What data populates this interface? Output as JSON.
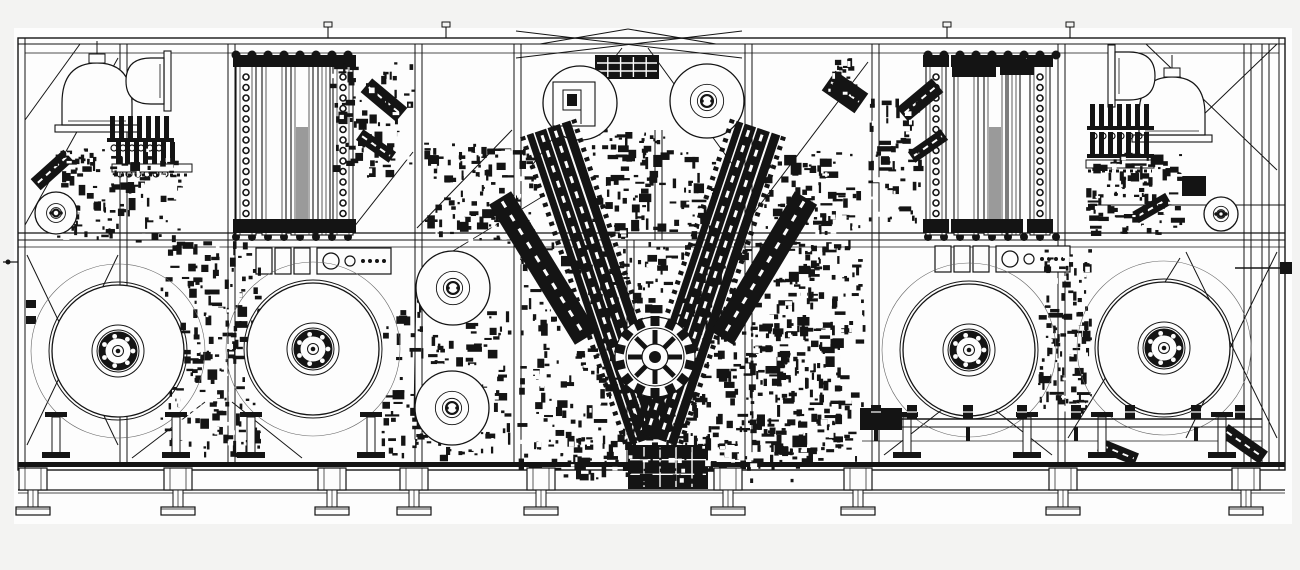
{
  "meta": {
    "canvas": {
      "w": 1300,
      "h": 570
    },
    "colors": {
      "ink": "#141414",
      "paper": "#fdfdfd",
      "page": "#f3f3f2",
      "faint": "#666666",
      "gray": "#9a9a9a"
    }
  },
  "frame": {
    "paper": [
      14,
      28,
      1278,
      496
    ],
    "outer": [
      18,
      38,
      1267,
      432
    ],
    "hlines": [
      [
        18,
        44,
        1285,
        1
      ],
      [
        25,
        53,
        1279,
        0.8
      ],
      [
        18,
        233,
        1285,
        1.2
      ],
      [
        18,
        240,
        1285,
        1
      ],
      [
        18,
        247,
        1285,
        0.7
      ],
      [
        1090,
        205,
        1285,
        1
      ],
      [
        862,
        441,
        1262,
        0.8
      ]
    ],
    "vlines": [
      [
        25,
        38,
        470,
        1
      ],
      [
        1279,
        38,
        470,
        1
      ]
    ],
    "columns": {
      "xs": [
        120,
        228,
        415,
        514,
        745,
        872,
        1058,
        1244,
        1262
      ],
      "y0": 44,
      "y1": 462,
      "w": 7
    },
    "partial_columns": [
      [
        627,
        240,
        462
      ],
      [
        655,
        130,
        240
      ]
    ],
    "base": {
      "x": 18,
      "w": 1267,
      "band_y": 462,
      "band_h": 5,
      "rail_y": 490,
      "rail2_y": 493
    },
    "stubs": [
      328,
      446,
      947,
      1070
    ],
    "left_marks": {
      "line": [
        3,
        262,
        18,
        262
      ],
      "dot": [
        8,
        262,
        2.5
      ],
      "tabs": [
        [
          26,
          300,
          10,
          8
        ],
        [
          26,
          316,
          10,
          8
        ]
      ]
    },
    "probe": {
      "line": [
        1235,
        268,
        1286,
        268
      ],
      "tip": [
        1280,
        262,
        12,
        12
      ]
    }
  },
  "braces": [
    [
      25,
      225,
      118,
      58
    ],
    [
      25,
      120,
      80,
      44
    ],
    [
      27,
      445,
      118,
      255
    ],
    [
      27,
      255,
      118,
      445
    ],
    [
      350,
      232,
      413,
      152
    ],
    [
      417,
      228,
      512,
      130
    ],
    [
      540,
      44,
      628,
      29
    ],
    [
      628,
      29,
      716,
      44
    ],
    [
      516,
      58,
      742,
      31
    ],
    [
      516,
      31,
      742,
      58
    ],
    [
      530,
      168,
      622,
      48
    ],
    [
      735,
      168,
      648,
      48
    ],
    [
      747,
      222,
      868,
      62
    ],
    [
      1146,
      44,
      1277,
      170
    ],
    [
      1277,
      44,
      1200,
      118
    ],
    [
      1186,
      252,
      1277,
      438
    ],
    [
      1277,
      252,
      1186,
      438
    ],
    [
      1068,
      438,
      1180,
      258
    ],
    [
      132,
      458,
      205,
      402
    ],
    [
      232,
      402,
      302,
      458
    ],
    [
      884,
      455,
      952,
      402
    ],
    [
      985,
      402,
      1052,
      455
    ],
    [
      416,
      290,
      414,
      410,
      0.8
    ],
    [
      453,
      251,
      545,
      195,
      0.8
    ]
  ],
  "towers": {
    "bays": [
      {
        "x0": 228,
        "x1": 360,
        "y0": 57,
        "y1": 235,
        "tracks": [
          {
            "x": 236,
            "w": 20,
            "chain": true
          },
          {
            "x": 262,
            "w": 24
          },
          {
            "x": 291,
            "w": 22,
            "gray": true
          },
          {
            "x": 318,
            "w": 12
          },
          {
            "x": 333,
            "w": 20,
            "chain": true
          }
        ]
      },
      {
        "x0": 920,
        "x1": 1074,
        "y0": 57,
        "y1": 235,
        "tracks": [
          {
            "x": 926,
            "w": 20,
            "chain": true
          },
          {
            "x": 954,
            "w": 24
          },
          {
            "x": 984,
            "w": 22,
            "gray": true
          },
          {
            "x": 1008,
            "w": 12
          },
          {
            "x": 1030,
            "w": 20,
            "chain": true
          }
        ]
      }
    ]
  },
  "domes": [
    {
      "cx": 97,
      "baseY": 132,
      "w": 70,
      "h": 62,
      "rot": 0,
      "neck": true
    },
    {
      "cx": 152,
      "baseY": 100,
      "w": 46,
      "h": 38,
      "rot": -90,
      "neck": false
    },
    {
      "cx": 1172,
      "baseY": 142,
      "w": 66,
      "h": 58,
      "rot": 0,
      "neck": true
    },
    {
      "cx": 1128,
      "baseY": 96,
      "w": 48,
      "h": 40,
      "rot": 90,
      "neck": false
    }
  ],
  "combs": [
    {
      "x": 110,
      "y": 116,
      "n": 7
    },
    {
      "x": 116,
      "y": 142,
      "n": 7
    },
    {
      "x": 1090,
      "y": 104,
      "n": 7
    },
    {
      "x": 1090,
      "y": 132,
      "n": 7
    }
  ],
  "toothed_rails": [
    [
      112,
      164,
      80
    ],
    [
      1086,
      160,
      68
    ]
  ],
  "modrows": [
    {
      "x": 256,
      "y": 248,
      "boxes": 3,
      "panel": true
    },
    {
      "x": 935,
      "y": 246,
      "boxes": 3,
      "panel": true
    }
  ],
  "reels": [
    {
      "cx": 118,
      "cy": 351
    },
    {
      "cx": 313,
      "cy": 349
    },
    {
      "cx": 969,
      "cy": 350
    },
    {
      "cx": 1164,
      "cy": 348
    }
  ],
  "reel_style": {
    "r_faint": 87,
    "r_ring": 69,
    "r_disc": 66,
    "hub_rings": [
      26,
      21
    ],
    "dark_r": 16,
    "bolt_radius": 15,
    "bolt_n": 7
  },
  "stand_offsets": [
    -62,
    58
  ],
  "rolls": [
    {
      "cx": 580,
      "cy": 103,
      "r": 37,
      "style": "boxed"
    },
    {
      "cx": 707,
      "cy": 101,
      "r": 37,
      "style": "hub"
    },
    {
      "cx": 453,
      "cy": 288,
      "r": 37,
      "style": "hub"
    },
    {
      "cx": 452,
      "cy": 408,
      "r": 37,
      "style": "hub"
    },
    {
      "cx": 56,
      "cy": 213,
      "r": 21,
      "style": "hub"
    },
    {
      "cx": 1221,
      "cy": 214,
      "r": 17,
      "style": "hub"
    }
  ],
  "arms": [
    {
      "p1": [
        548,
        128
      ],
      "p2": [
        652,
        438
      ],
      "outer": false
    },
    {
      "p1": [
        758,
        128
      ],
      "p2": [
        654,
        438
      ],
      "outer": false
    },
    {
      "p1": [
        500,
        198
      ],
      "p2": [
        586,
        338
      ],
      "outer": true
    },
    {
      "p1": [
        806,
        198
      ],
      "p2": [
        722,
        338
      ],
      "outer": true
    }
  ],
  "gear": {
    "cx": 655,
    "cy": 357,
    "r": 40,
    "teeth": 14,
    "spokes": 8
  },
  "conveyor": {
    "y": 419,
    "y2": 427,
    "x0": 862,
    "x1": 1262,
    "posts": [
      876,
      912,
      968,
      1022,
      1076,
      1130,
      1196,
      1240
    ],
    "end_block": [
      860,
      408,
      42,
      22
    ]
  },
  "chutes": [
    {
      "cx": 1244,
      "cy": 444,
      "w": 48,
      "h": 15,
      "rot": 35
    },
    {
      "cx": 1118,
      "cy": 452,
      "w": 40,
      "h": 13,
      "rot": 22
    },
    {
      "cx": 384,
      "cy": 100,
      "w": 46,
      "h": 18,
      "rot": 40
    },
    {
      "cx": 376,
      "cy": 146,
      "w": 40,
      "h": 13,
      "rot": 35
    },
    {
      "cx": 920,
      "cy": 100,
      "w": 46,
      "h": 18,
      "rot": -40
    },
    {
      "cx": 928,
      "cy": 146,
      "w": 40,
      "h": 13,
      "rot": -35
    },
    {
      "cx": 52,
      "cy": 170,
      "w": 44,
      "h": 15,
      "rot": -42
    },
    {
      "cx": 1152,
      "cy": 208,
      "w": 38,
      "h": 13,
      "rot": -30
    },
    {
      "cx": 845,
      "cy": 92,
      "w": 40,
      "h": 24,
      "rot": 35
    }
  ],
  "blocks": [
    {
      "x": 595,
      "y": 55,
      "w": 64,
      "h": 24,
      "grid": true
    },
    {
      "x": 952,
      "y": 57,
      "w": 44,
      "h": 20,
      "grid": false
    },
    {
      "x": 1000,
      "y": 59,
      "w": 34,
      "h": 16,
      "grid": false
    },
    {
      "x": 628,
      "y": 445,
      "w": 80,
      "h": 44,
      "grid": true
    },
    {
      "x": 1182,
      "y": 176,
      "w": 24,
      "h": 20,
      "grid": false
    }
  ],
  "clusters": [
    {
      "x": 55,
      "y": 148,
      "w": 130,
      "h": 95,
      "n": 110,
      "seed": 11
    },
    {
      "x": 330,
      "y": 62,
      "w": 88,
      "h": 118,
      "n": 70,
      "seed": 12
    },
    {
      "x": 420,
      "y": 142,
      "w": 118,
      "h": 102,
      "n": 110,
      "seed": 13
    },
    {
      "x": 866,
      "y": 98,
      "w": 58,
      "h": 130,
      "n": 50,
      "seed": 14
    },
    {
      "x": 1086,
      "y": 152,
      "w": 100,
      "h": 84,
      "n": 90,
      "seed": 15
    },
    {
      "x": 160,
      "y": 240,
      "w": 104,
      "h": 218,
      "n": 180,
      "seed": 16
    },
    {
      "x": 1038,
      "y": 248,
      "w": 54,
      "h": 168,
      "n": 100,
      "seed": 17
    },
    {
      "x": 380,
      "y": 300,
      "w": 132,
      "h": 162,
      "n": 150,
      "seed": 18
    },
    {
      "x": 742,
      "y": 240,
      "w": 124,
      "h": 224,
      "n": 160,
      "seed": 19
    },
    {
      "x": 588,
      "y": 128,
      "w": 132,
      "h": 112,
      "n": 120,
      "seed": 20
    },
    {
      "x": 516,
      "y": 242,
      "w": 330,
      "h": 230,
      "n": 500,
      "seed": 21
    },
    {
      "x": 560,
      "y": 430,
      "w": 250,
      "h": 56,
      "n": 90,
      "seed": 22
    },
    {
      "x": 828,
      "y": 58,
      "w": 30,
      "h": 40,
      "n": 18,
      "seed": 23
    },
    {
      "x": 762,
      "y": 150,
      "w": 100,
      "h": 86,
      "n": 80,
      "seed": 26
    }
  ],
  "feet": {
    "xs": [
      33,
      178,
      332,
      414,
      541,
      728,
      858,
      1063,
      1246
    ],
    "block_y": 468,
    "block_h": 22,
    "stem_y": 490,
    "stem_h": 17,
    "pad_y": 507,
    "pad_h": 8
  }
}
